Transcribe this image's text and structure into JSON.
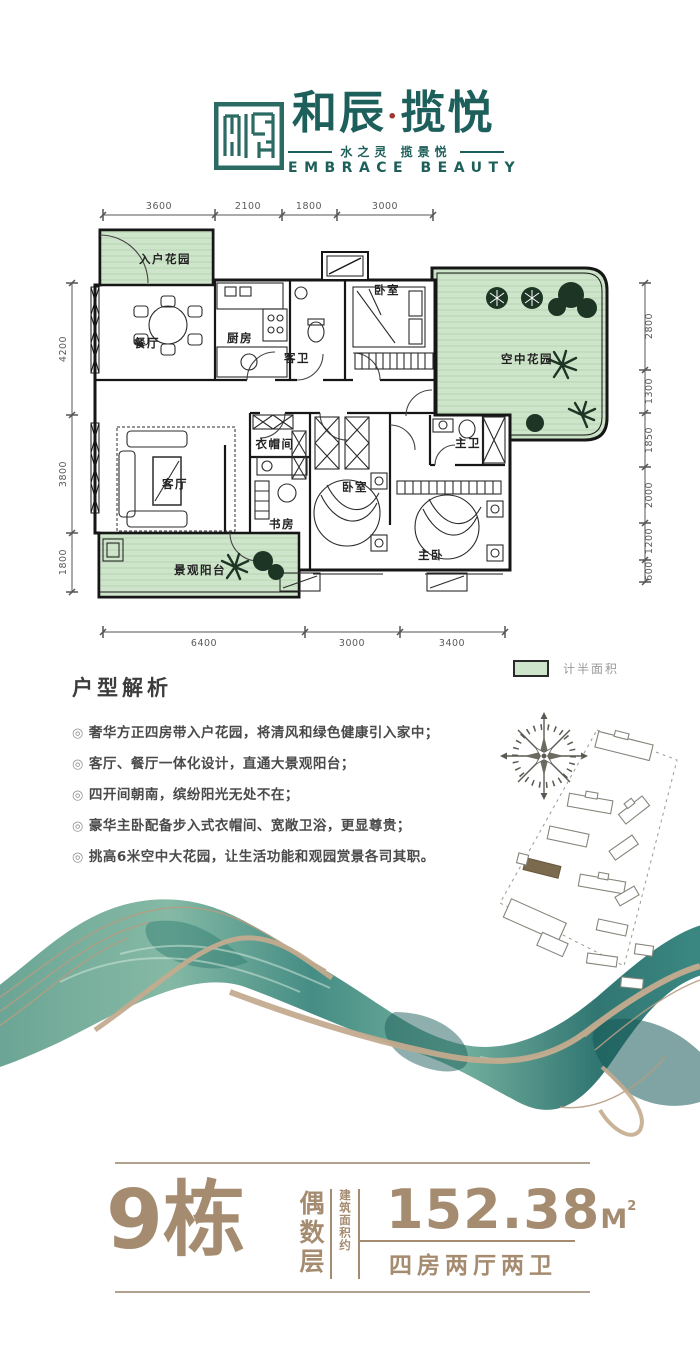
{
  "brand": {
    "name_left": "和辰",
    "name_dot": "·",
    "name_right": "揽悦",
    "tagline": "水之灵 揽景悦",
    "tagline_en": "EMBRACE BEAUTY",
    "colors": {
      "teal": "#1d5f5a",
      "dot_red": "#9e3730"
    }
  },
  "floorplan": {
    "dims_top": [
      "3600",
      "2100",
      "1800",
      "3000"
    ],
    "dims_left": [
      "4200",
      "3800",
      "1800"
    ],
    "dims_right": [
      "2800",
      "1300",
      "1850",
      "2000",
      "1200",
      "600"
    ],
    "dims_bottom": [
      "6400",
      "3000",
      "3400"
    ],
    "rooms": {
      "entry_garden": "入户花园",
      "dining": "餐厅",
      "kitchen": "厨房",
      "guest_bath": "客卫",
      "bedroom_top": "卧室",
      "sky_garden": "空中花园",
      "living": "客厅",
      "cloakroom": "衣帽间",
      "study": "书房",
      "bedroom_mid": "卧室",
      "master_bath": "主卫",
      "master_bedroom": "主卧",
      "balcony": "景观阳台"
    },
    "legend": {
      "label": "计半面积",
      "swatch_color": "#cfe5cb"
    }
  },
  "analysis": {
    "title": "户型解析",
    "bullet_char": "◎",
    "bullets": [
      "奢华方正四房带入户花园，将清风和绿色健康引入家中；",
      "客厅、餐厅一体化设计，直通大景观阳台；",
      "四开间朝南，缤纷阳光无处不在；",
      "豪华主卧配备步入式衣帽间、宽敞卫浴，更显尊贵；",
      "挑高6米空中大花园，让生活功能和观园赏景各司其职。"
    ]
  },
  "summary": {
    "building": "9栋",
    "floor_type": "偶数层",
    "area_label": "建筑面积约",
    "area_value": "152.38",
    "area_unit": "M",
    "area_sup": "2",
    "layout": "四房两厅两卫",
    "accent_color": "#a58c70"
  }
}
